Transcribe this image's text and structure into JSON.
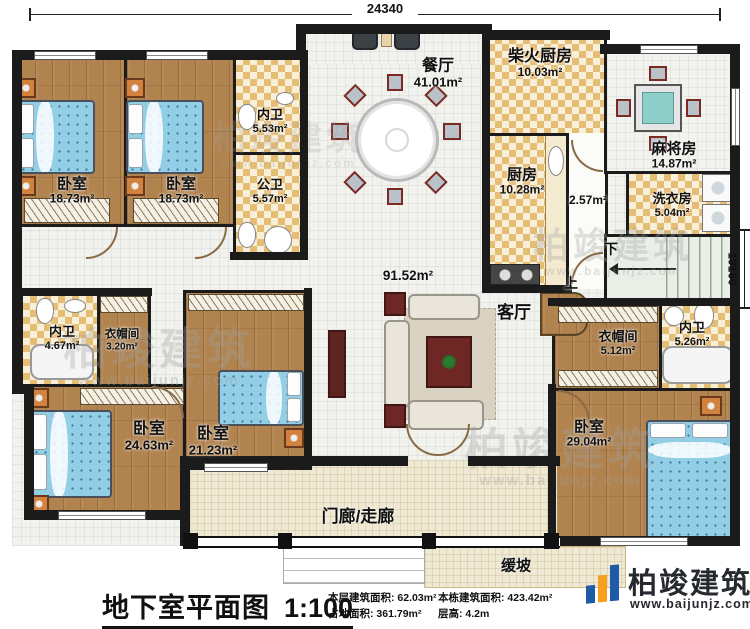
{
  "dimensions": {
    "top": "24340",
    "right": "19160"
  },
  "rooms": {
    "bedroom_tl1": {
      "label": "卧室",
      "area": "18.73m²"
    },
    "bedroom_tl2": {
      "label": "卧室",
      "area": "18.73m²"
    },
    "neiwei_top": {
      "label": "内卫",
      "area": "5.53m²"
    },
    "gongwei": {
      "label": "公卫",
      "area": "5.57m²"
    },
    "dining": {
      "label": "餐厅",
      "area": "41.01m²"
    },
    "firewood_kitchen": {
      "label": "柴火厨房",
      "area": "10.03m²"
    },
    "kitchen": {
      "label": "厨房",
      "area": "10.28m²"
    },
    "mahjong": {
      "label": "麻将房",
      "area": "14.87m²"
    },
    "laundry": {
      "label": "洗衣房",
      "area": "5.04m²"
    },
    "hallway": {
      "label": "",
      "area": "2.57m²"
    },
    "living": {
      "label": "客厅",
      "area": "91.52m²"
    },
    "neiwei_left": {
      "label": "内卫",
      "area": "4.67m²"
    },
    "cloak_left": {
      "label": "衣帽间",
      "area": "3.20m²"
    },
    "bedroom_bl1": {
      "label": "卧室",
      "area": "24.63m²"
    },
    "bedroom_bl2": {
      "label": "卧室",
      "area": "21.23m²"
    },
    "cloak_right": {
      "label": "衣帽间",
      "area": "5.12m²"
    },
    "neiwei_right": {
      "label": "内卫",
      "area": "5.26m²"
    },
    "bedroom_br": {
      "label": "卧室",
      "area": "29.04m²"
    },
    "porch": {
      "label": "门廊/走廊",
      "area": ""
    },
    "ramp": {
      "label": "缓坡",
      "area": ""
    }
  },
  "stairs": {
    "down": "下",
    "up": "上"
  },
  "footer": {
    "plan_title": "地下室平面图",
    "plan_scale": "1:100",
    "stats": [
      {
        "label": "本层建筑面积:",
        "value": "62.03m²"
      },
      {
        "label": "占地面积:",
        "value": "361.79m²"
      },
      {
        "label": "本栋建筑面积:",
        "value": "423.42m²"
      },
      {
        "label": "层高:",
        "value": "4.2m"
      }
    ],
    "logo_name": "柏竣建筑",
    "logo_url": "www.baijunjz.com"
  },
  "watermark": {
    "name": "柏竣建筑",
    "url": "www.baijunjz.com"
  },
  "colors": {
    "wall": "#1b1b1b",
    "wood_floor": "#b1834f",
    "tile_accent": "#e6bd75",
    "bed_blue": "#92cfe7",
    "logo_blue": "#1e5aa6",
    "logo_orange": "#f5a01f"
  }
}
